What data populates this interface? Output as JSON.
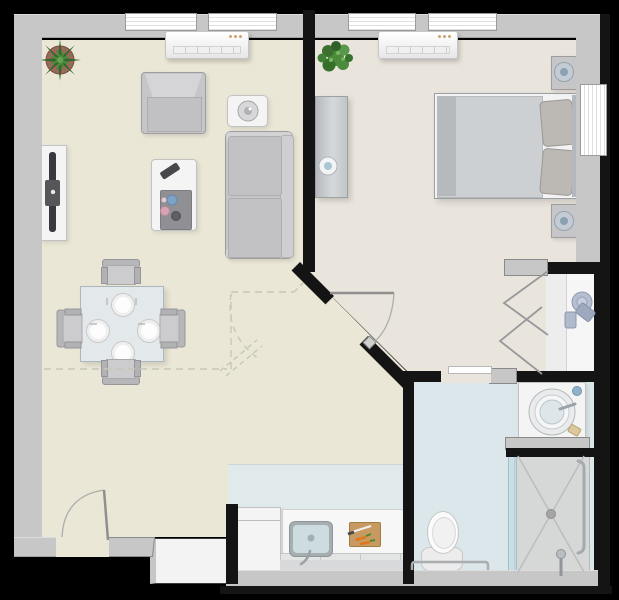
{
  "palette": {
    "outside": "#000000",
    "wall": "#c7c7c7",
    "partition": "#141414",
    "living-floor": "#ebe7d6",
    "bedroom-floor": "#e9e4dc",
    "bathroom-floor": "#dbe7ea",
    "kitchen-floor": "#e0eaea",
    "closet-floor": "#ededee",
    "furniture-white": "#f4f4f5",
    "furniture-gray": "#c6c6c8",
    "glass-blue": "#cfe0e6",
    "plant-green": "#3f7d33",
    "pot-red": "#a2655c",
    "wood-board": "#c69a60",
    "carrot-orange": "#e0761c",
    "slate-item": "#a9b4c9"
  },
  "rooms": {
    "living_room": {
      "floor_color": "#ebe7d6",
      "items": [
        "potted-plant",
        "wall-ac-unit",
        "window",
        "tv-console",
        "armchair",
        "side-table-with-lamp",
        "sofa",
        "coffee-table-with-tray-and-remote",
        "dining-table-four-plates",
        "four-dining-chairs",
        "entry-door-with-swing-arc",
        "dashed-clearance-lines"
      ]
    },
    "bedroom": {
      "floor_color": "#e9e4dc",
      "items": [
        "potted-plant",
        "wall-ac-unit",
        "window-top",
        "window-right",
        "dresser-with-bowl",
        "double-bed-two-pillows",
        "nightstand-lamp-top",
        "nightstand-lamp-bottom",
        "diagonal-door-with-swing-arc"
      ]
    },
    "closet": {
      "floor_color": "#ededee",
      "items": [
        "bifold-doors",
        "shelf",
        "hat-box",
        "storage-boxes"
      ]
    },
    "bathroom": {
      "floor_color": "#dbe7ea",
      "items": [
        "sliding-door",
        "vanity-round-basin",
        "soap-items",
        "shower-with-glass-panel",
        "shower-drain",
        "shower-head",
        "grab-bars",
        "toilet"
      ]
    },
    "kitchen": {
      "floor_color": "#e0eaea",
      "items": [
        "refrigerator",
        "counter",
        "sink-with-faucet",
        "cutting-board-knife-carrots"
      ]
    }
  }
}
